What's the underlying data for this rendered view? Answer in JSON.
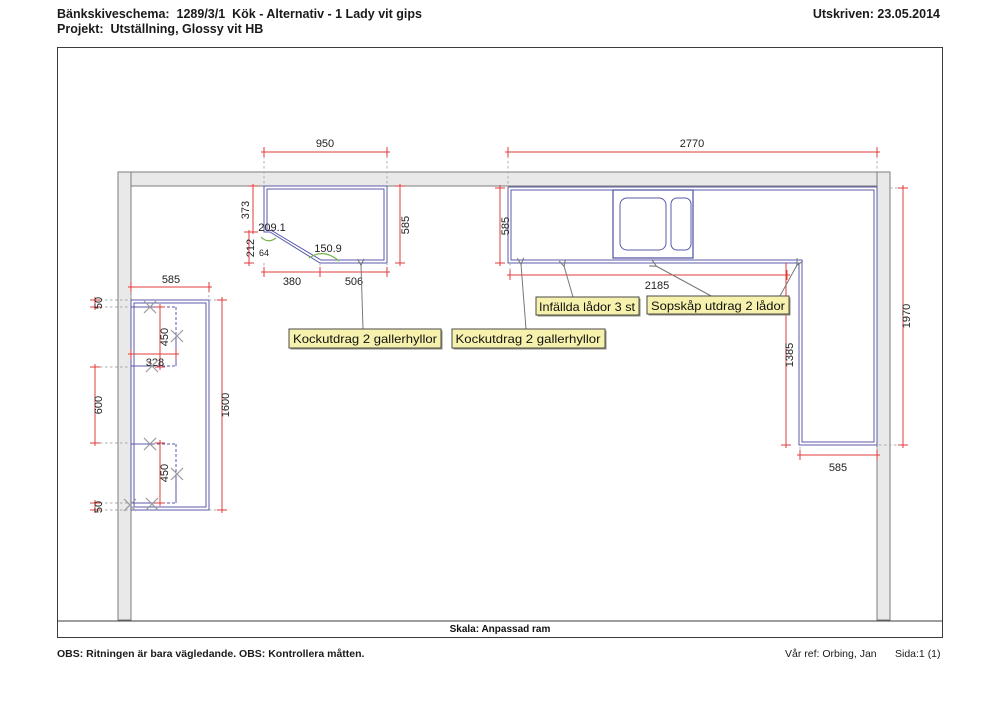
{
  "header": {
    "line1": "Bänkskiveschema:  1289/3/1  Kök - Alternativ - 1 Lady vit gips",
    "line2": "Projekt:  Utställning, Glossy vit HB",
    "printed": "Utskriven: 23.05.2014"
  },
  "annotations": {
    "kockutdrag": "Kockutdrag 2 gallerhyllor",
    "infallda": "Infällda lådor 3 st",
    "sopskap": "Sopskåp utdrag 2 lådor"
  },
  "dimensions": {
    "w950": "950",
    "w2770": "2770",
    "h373": "373",
    "h212": "212",
    "w64": "64",
    "h585_left": "585",
    "w380": "380",
    "w506": "506",
    "h585_right": "585",
    "w2185": "2185",
    "h1385": "1385",
    "h1970": "1970",
    "w585_leg": "585",
    "w585_island": "585",
    "h50_top": "50",
    "h450_top": "450",
    "w328": "328",
    "h600": "600",
    "h1600": "1600",
    "h450_bottom": "450",
    "h50_bottom": "50"
  },
  "angles": {
    "a209": "209.1",
    "a150": "150.9"
  },
  "scale_text": "Skala: Anpassad ram",
  "footer": {
    "note": "OBS: Ritningen är bara vägledande. OBS: Kontrollera måtten.",
    "our_ref": "Vår ref: Orbing, Jan",
    "page": "Sida:1 (1)"
  },
  "colors": {
    "dimension": "#e23b3b",
    "counter": "#585aa8",
    "angle_arc": "#74b44a",
    "wall_fill": "#e9e9e9",
    "label_bg": "#f6f1ac"
  }
}
